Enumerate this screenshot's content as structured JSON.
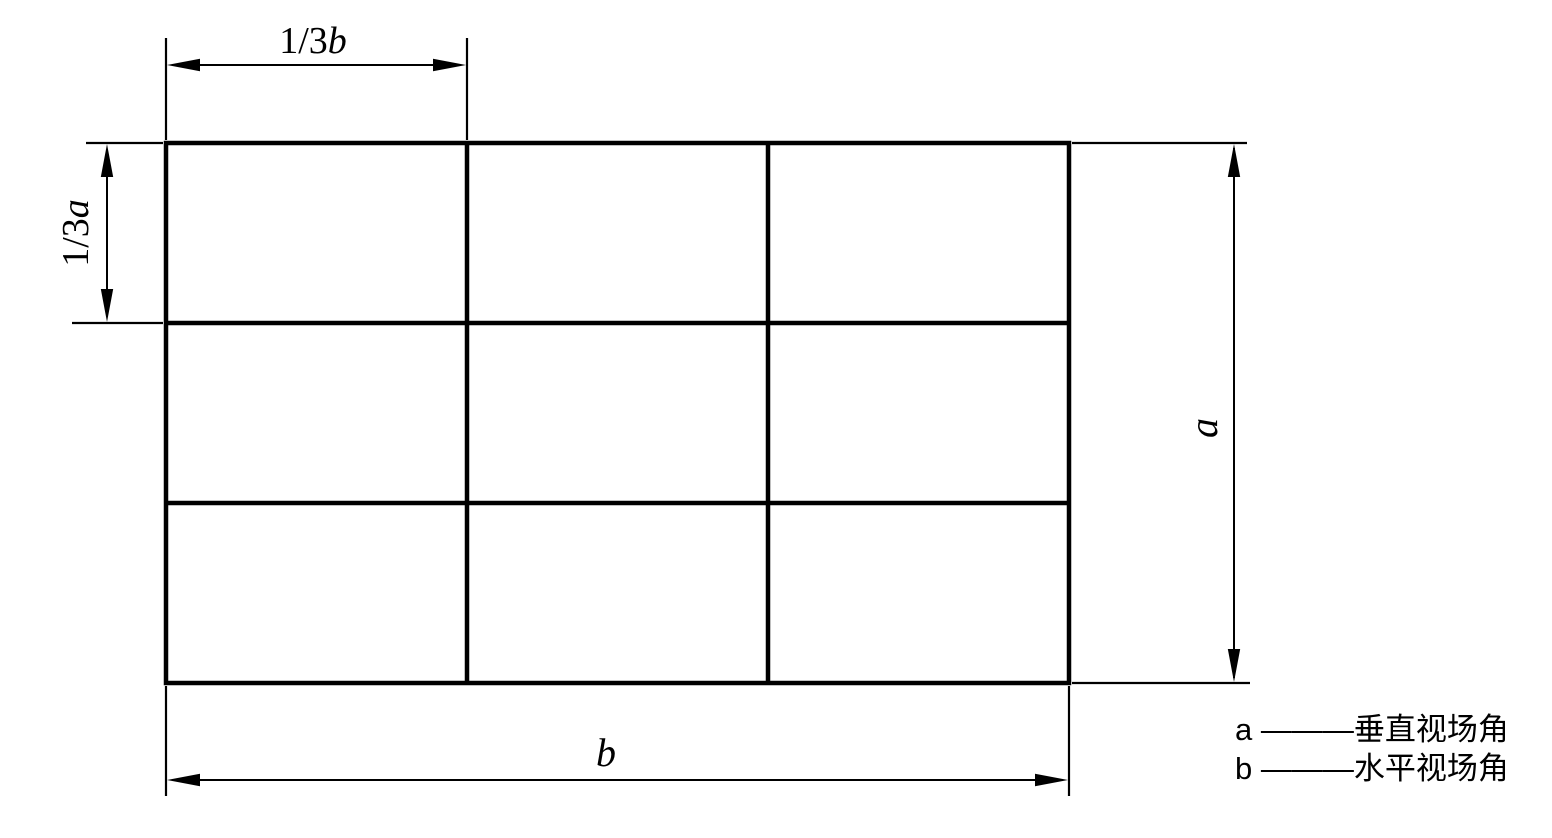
{
  "colors": {
    "line": "#000000",
    "background": "#ffffff"
  },
  "grid": {
    "rows": 3,
    "cols": 3
  },
  "dimensions": {
    "top": {
      "prefix": "1/3",
      "variable": "b"
    },
    "left": {
      "prefix": "1/3",
      "variable": "a"
    },
    "right": {
      "variable": "a"
    },
    "bottom": {
      "variable": "b"
    }
  },
  "legend": {
    "items": [
      {
        "text": "a ———垂直视场角"
      },
      {
        "text": "b ———水平视场角"
      }
    ]
  }
}
